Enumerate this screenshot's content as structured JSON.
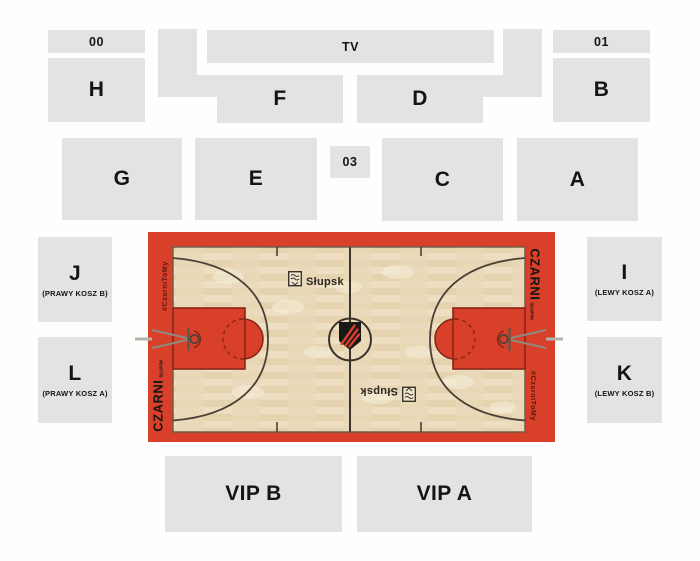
{
  "venue_map": {
    "sections": {
      "s00": {
        "label": "00"
      },
      "s01": {
        "label": "01"
      },
      "s03": {
        "label": "03"
      },
      "tv": {
        "label": "TV"
      },
      "a": {
        "label": "A"
      },
      "b": {
        "label": "B"
      },
      "c": {
        "label": "C"
      },
      "d": {
        "label": "D"
      },
      "e": {
        "label": "E"
      },
      "f": {
        "label": "F"
      },
      "g": {
        "label": "G"
      },
      "h": {
        "label": "H"
      },
      "j": {
        "label": "J",
        "sublabel": "(PRAWY KOSZ B)"
      },
      "l": {
        "label": "L",
        "sublabel": "(PRAWY KOSZ A)"
      },
      "i": {
        "label": "I",
        "sublabel": "(LEWY KOSZ A)"
      },
      "k": {
        "label": "K",
        "sublabel": "(LEWY KOSZ B)"
      },
      "vipB": {
        "label": "VIP B"
      },
      "vipA": {
        "label": "VIP A"
      }
    },
    "court": {
      "city_label": "Słupsk",
      "team_label": "CZARNI",
      "team_sublabel": "SŁUPSK",
      "hashtag": "#CzarniToMy",
      "colors": {
        "court_red": "#d8402a",
        "court_red_dark": "#8a2418",
        "wood": "#ebdcbd",
        "line": "#4a4136",
        "section_gray": "#e3e3e1"
      }
    }
  }
}
